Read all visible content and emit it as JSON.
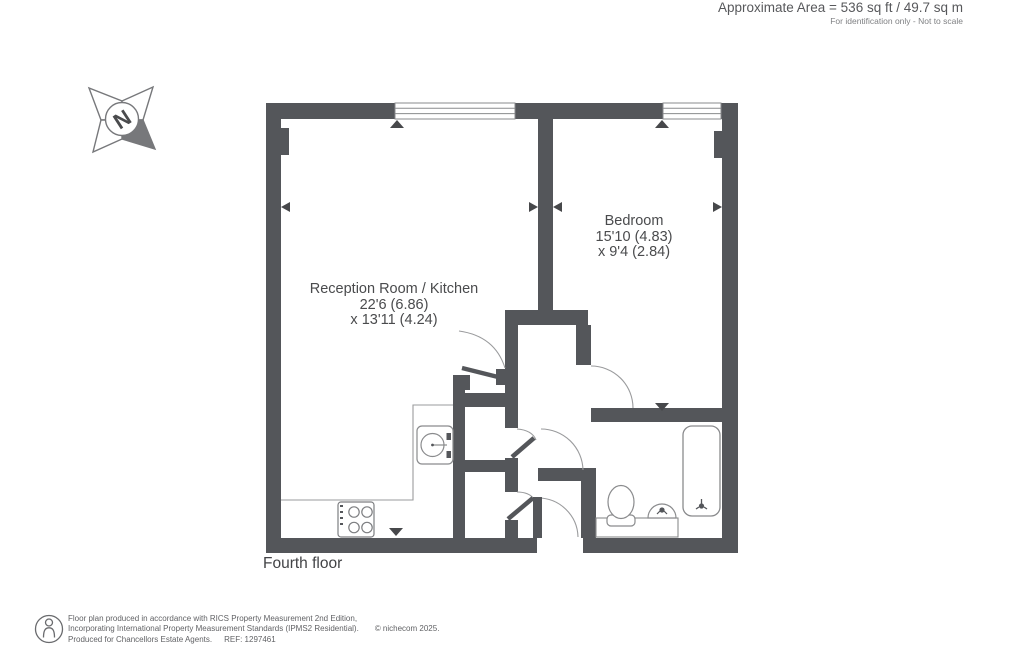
{
  "header": {
    "area_line": "Approximate Area = 536 sq ft / 49.7 sq m",
    "scale_note": "For identification only - Not to scale"
  },
  "plan": {
    "floor_label": "Fourth floor",
    "compass": {
      "letter": "N"
    },
    "rooms": [
      {
        "name": "Reception Room / Kitchen",
        "dim_imperial_metric_1": "22'6 (6.86)",
        "dim_imperial_metric_2": "x 13'11 (4.24)"
      },
      {
        "name": "Bedroom",
        "dim_imperial_metric_1": "15'10 (4.83)",
        "dim_imperial_metric_2": "x 9'4 (2.84)"
      }
    ],
    "colors": {
      "wall": "#54565a",
      "fixture_line": "#8a8b8d",
      "arc_line": "#9a9b9d",
      "text": "#4a4b4d"
    }
  },
  "footer": {
    "line1": "Floor plan produced in accordance with RICS Property Measurement 2nd Edition,",
    "line2": "Incorporating International Property Measurement Standards (IPMS2 Residential).",
    "copyright": "© nichecom 2025.",
    "line3": "Produced for Chancellors Estate Agents.",
    "ref": "REF: 1297461"
  }
}
